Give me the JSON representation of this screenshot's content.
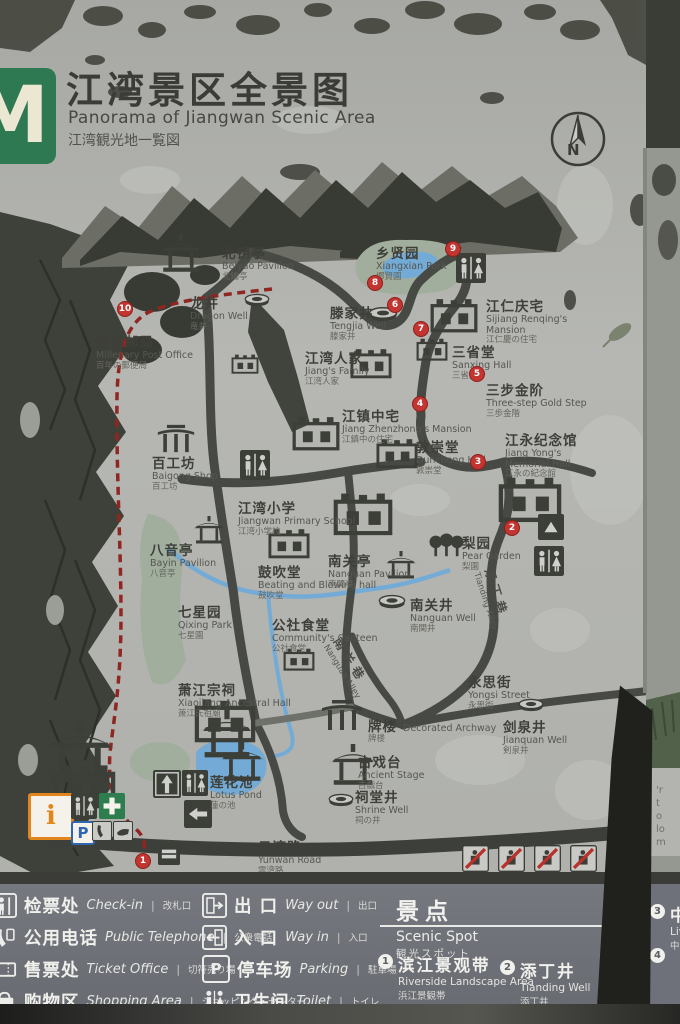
{
  "sign": {
    "logo_letter": "M",
    "title_zh": "江湾景区全景图",
    "title_en": "Panorama of Jiangwan Scenic Area",
    "title_ja": "江湾観光地一覧図",
    "compass_n": "N"
  },
  "colors": {
    "concrete": "#b2b3af",
    "ink": "#3c3e38",
    "road": "#474944",
    "water": "#74abd6",
    "park": "#a1ae9d",
    "marker_red": "#c23530",
    "route_red": "#8f2621",
    "legend_band": "#6e717a",
    "logo_green": "#2e7951",
    "info_orange": "#e2861c",
    "parking_blue": "#2f66b0"
  },
  "icons": {
    "parking_letter": "P",
    "info_letter": "i"
  },
  "map": {
    "locations": [
      {
        "id": "beiyao-pavilion",
        "zh": "北钥亭",
        "en": "Beiyao Pavilion",
        "ja": "北鑰亭",
        "x": 222,
        "y": 247
      },
      {
        "id": "dragon-well",
        "zh": "龙井",
        "en": "Dragon Well",
        "ja": "竜井",
        "x": 190,
        "y": 297
      },
      {
        "id": "millenary-post-office",
        "zh": "百年邮局",
        "en": "Millenary Post Office",
        "ja": "百年の郵便局",
        "x": 96,
        "y": 336
      },
      {
        "id": "tengjia-well",
        "zh": "滕家井",
        "en": "Tengjia Well",
        "ja": "滕家井",
        "x": 330,
        "y": 307
      },
      {
        "id": "xiangxian-park",
        "zh": "乡贤园",
        "en": "Xiangxian Park",
        "ja": "郷賢園",
        "x": 376,
        "y": 247
      },
      {
        "id": "sijiang-renqing-mansion",
        "zh": "江仁庆宅",
        "en": "Sijiang Renqing's Mansion",
        "ja": "江仁慶の住宅",
        "x": 486,
        "y": 300,
        "wrap": 100
      },
      {
        "id": "sanxing-hall",
        "zh": "三省堂",
        "en": "Sanxing Hall",
        "ja": "三省堂",
        "x": 452,
        "y": 346
      },
      {
        "id": "three-step-gold-step",
        "zh": "三步金阶",
        "en": "Three-step Gold Step",
        "ja": "三歩金階",
        "x": 486,
        "y": 384
      },
      {
        "id": "jiangs-family",
        "zh": "江湾人家",
        "en": "Jiang's Family",
        "ja": "江湾人家",
        "x": 305,
        "y": 352
      },
      {
        "id": "jiang-zhenzhong-mansion",
        "zh": "江镇中宅",
        "en": "Jiang Zhenzhong's Mansion",
        "ja": "江鎮中の住宅",
        "x": 342,
        "y": 410
      },
      {
        "id": "dunchong-hall",
        "zh": "敦崇堂",
        "en": "Dunchong Hall",
        "ja": "敦崇堂",
        "x": 416,
        "y": 441
      },
      {
        "id": "jiang-yong-memorial-hall",
        "zh": "江永纪念馆",
        "en": "Jiang Yong's Memorial Hall",
        "ja": "江永の紀念館",
        "x": 505,
        "y": 434,
        "wrap": 92
      },
      {
        "id": "baigong-shop",
        "zh": "百工坊",
        "en": "Baigong Shop",
        "ja": "百工坊",
        "x": 152,
        "y": 457
      },
      {
        "id": "jiangwan-primary-school",
        "zh": "江湾小学",
        "en": "Jiangwan Primary School",
        "ja": "江湾小学校",
        "x": 238,
        "y": 502
      },
      {
        "id": "bayin-pavilion",
        "zh": "八音亭",
        "en": "Bayin Pavilion",
        "ja": "八音亭",
        "x": 150,
        "y": 544
      },
      {
        "id": "beating-blowing-hall",
        "zh": "鼓吹堂",
        "en": "Beating and Blowing hall",
        "ja": "鼓吹堂",
        "x": 258,
        "y": 566
      },
      {
        "id": "nanguan-pavilion",
        "zh": "南关亭",
        "en": "Nanguan Pavilion",
        "ja": "南関亭",
        "x": 328,
        "y": 555
      },
      {
        "id": "pear-garden",
        "zh": "梨园",
        "en": "Pear Garden",
        "ja": "梨園",
        "x": 462,
        "y": 537
      },
      {
        "id": "nanguan-well",
        "zh": "南关井",
        "en": "Nanguan Well",
        "ja": "南関井",
        "x": 410,
        "y": 599
      },
      {
        "id": "qixing-park",
        "zh": "七星园",
        "en": "Qixing Park",
        "ja": "七星園",
        "x": 178,
        "y": 606
      },
      {
        "id": "communitys-canteen",
        "zh": "公社食堂",
        "en": "Community's Canteen",
        "ja": "公社食堂",
        "x": 272,
        "y": 619
      },
      {
        "id": "xiaojiang-ancestral-hall",
        "zh": "萧江宗祠",
        "en": "Xiaojiang Ancestral Hall",
        "ja": "萧江氏祖廟",
        "x": 178,
        "y": 684
      },
      {
        "id": "yongsi-street",
        "zh": "永思街",
        "en": "Yongsi Street",
        "ja": "永思街",
        "x": 468,
        "y": 676
      },
      {
        "id": "decorated-archway",
        "zh": "牌楼",
        "en": "Decorated Archway",
        "ja": "牌楼",
        "x": 368,
        "y": 717,
        "layout": "inline"
      },
      {
        "id": "jianquan-well",
        "zh": "剑泉井",
        "en": "Jianquan Well",
        "ja": "剣泉井",
        "x": 503,
        "y": 721
      },
      {
        "id": "ancient-stage",
        "zh": "古戏台",
        "en": "Ancient Stage",
        "ja": "古戯台",
        "x": 358,
        "y": 756
      },
      {
        "id": "shrine-well",
        "zh": "祠堂井",
        "en": "Shrine Well",
        "ja": "祠の井",
        "x": 355,
        "y": 791
      },
      {
        "id": "lotus-pond",
        "zh": "莲花池",
        "en": "Lotus Pond",
        "ja": "蓮の池",
        "x": 210,
        "y": 776
      },
      {
        "id": "yunwan-road",
        "zh": "云湾路",
        "en": "Yunwan Road",
        "ja": "雲湾路",
        "x": 258,
        "y": 841
      }
    ],
    "alley_labels": [
      {
        "id": "tianding-alley",
        "zh": "添丁巷",
        "en": "Tianding Alley",
        "x": 497,
        "y": 566,
        "rotate": 72
      },
      {
        "id": "nanguan-alley",
        "zh": "南关巷",
        "en": "Nanguan Alley",
        "x": 344,
        "y": 634,
        "rotate": 58
      }
    ],
    "markers": [
      {
        "num": "1",
        "x": 143,
        "y": 861
      },
      {
        "num": "2",
        "x": 512,
        "y": 528
      },
      {
        "num": "3",
        "x": 478,
        "y": 462
      },
      {
        "num": "4",
        "x": 420,
        "y": 404
      },
      {
        "num": "5",
        "x": 477,
        "y": 374
      },
      {
        "num": "6",
        "x": 395,
        "y": 305
      },
      {
        "num": "7",
        "x": 421,
        "y": 329
      },
      {
        "num": "8",
        "x": 375,
        "y": 283
      },
      {
        "num": "9",
        "x": 453,
        "y": 249
      },
      {
        "num": "10",
        "x": 125,
        "y": 309
      }
    ],
    "icons": [
      {
        "type": "pavilion",
        "x": 158,
        "y": 234,
        "s": 46
      },
      {
        "type": "well",
        "x": 244,
        "y": 291,
        "s": 26
      },
      {
        "type": "house",
        "x": 231,
        "y": 354,
        "s": 28
      },
      {
        "type": "well",
        "x": 368,
        "y": 304,
        "s": 30
      },
      {
        "type": "toilet",
        "x": 456,
        "y": 253,
        "s": 30
      },
      {
        "type": "house",
        "x": 430,
        "y": 298,
        "s": 48
      },
      {
        "type": "house",
        "x": 416,
        "y": 338,
        "s": 32
      },
      {
        "type": "house",
        "x": 350,
        "y": 348,
        "s": 42
      },
      {
        "type": "house",
        "x": 292,
        "y": 416,
        "s": 48
      },
      {
        "type": "house",
        "x": 376,
        "y": 438,
        "s": 42
      },
      {
        "type": "house",
        "x": 498,
        "y": 476,
        "s": 64
      },
      {
        "type": "archway",
        "x": 156,
        "y": 423,
        "s": 40
      },
      {
        "type": "toilet",
        "x": 240,
        "y": 450,
        "s": 30
      },
      {
        "type": "house",
        "x": 333,
        "y": 492,
        "s": 60
      },
      {
        "type": "pavilion",
        "x": 192,
        "y": 516,
        "s": 34
      },
      {
        "type": "house",
        "x": 268,
        "y": 528,
        "s": 42
      },
      {
        "type": "pavilion",
        "x": 384,
        "y": 551,
        "s": 34
      },
      {
        "type": "trees",
        "x": 428,
        "y": 533,
        "s": 36
      },
      {
        "type": "sign-dark",
        "x": 538,
        "y": 514,
        "s": 26
      },
      {
        "type": "toilet",
        "x": 534,
        "y": 546,
        "s": 30
      },
      {
        "type": "well",
        "x": 378,
        "y": 592,
        "s": 28
      },
      {
        "type": "house",
        "x": 283,
        "y": 648,
        "s": 32
      },
      {
        "type": "house",
        "x": 194,
        "y": 698,
        "s": 62
      },
      {
        "type": "pavilion",
        "x": 42,
        "y": 720,
        "s": 76
      },
      {
        "type": "house",
        "x": 54,
        "y": 764,
        "s": 62
      },
      {
        "type": "pavilion",
        "x": 198,
        "y": 710,
        "s": 58
      },
      {
        "type": "pavilion",
        "x": 218,
        "y": 742,
        "s": 48
      },
      {
        "type": "archway",
        "x": 320,
        "y": 698,
        "s": 44
      },
      {
        "type": "well",
        "x": 518,
        "y": 696,
        "s": 26
      },
      {
        "type": "pavilion",
        "x": 328,
        "y": 744,
        "s": 50
      },
      {
        "type": "well",
        "x": 328,
        "y": 791,
        "s": 26
      },
      {
        "type": "way-in",
        "x": 153,
        "y": 770,
        "s": 28
      },
      {
        "type": "toilet",
        "x": 182,
        "y": 770,
        "s": 26
      },
      {
        "type": "way-out",
        "x": 184,
        "y": 800,
        "s": 28
      },
      {
        "type": "ticket-dark",
        "x": 158,
        "y": 843,
        "s": 22
      },
      {
        "type": "info-box",
        "x": 28,
        "y": 793,
        "s": 40
      },
      {
        "type": "toilet",
        "x": 71,
        "y": 793,
        "s": 26
      },
      {
        "type": "cross-box",
        "x": 99,
        "y": 793,
        "s": 26
      },
      {
        "type": "p-box",
        "x": 71,
        "y": 821,
        "s": 20
      },
      {
        "type": "phone-box",
        "x": 92,
        "y": 821,
        "s": 20
      },
      {
        "type": "hand-box",
        "x": 113,
        "y": 821,
        "s": 20
      },
      {
        "type": "prohibit",
        "x": 462,
        "y": 845,
        "s": 27
      },
      {
        "type": "prohibit",
        "x": 498,
        "y": 845,
        "s": 27
      },
      {
        "type": "prohibit",
        "x": 534,
        "y": 845,
        "s": 27
      },
      {
        "type": "prohibit",
        "x": 570,
        "y": 845,
        "s": 27
      }
    ]
  },
  "legend": {
    "separator": "|",
    "columns": [
      {
        "x": -8,
        "items": [
          {
            "icon": "checkin",
            "zh": "检票处",
            "en": "Check-in",
            "ja": "改札口"
          },
          {
            "icon": "phone",
            "zh": "公用电话",
            "en": "Public Telephone",
            "ja": "公衆電話"
          },
          {
            "icon": "ticket",
            "zh": "售票处",
            "en": "Ticket Office",
            "ja": "切符売り場"
          },
          {
            "icon": "shopping",
            "zh": "购物区",
            "en": "Shopping Area",
            "ja": "ショッピング・センター"
          }
        ]
      },
      {
        "x": 202,
        "items": [
          {
            "icon": "way-out",
            "zh": "出 口",
            "en": "Way out",
            "ja": "出口"
          },
          {
            "icon": "way-in",
            "zh": "入 口",
            "en": "Way in",
            "ja": "入口"
          },
          {
            "icon": "parking",
            "zh": "停车场",
            "en": "Parking",
            "ja": "駐車場"
          },
          {
            "icon": "toilet",
            "zh": "卫生间",
            "en": "Toilet",
            "ja": "トイレ"
          }
        ]
      }
    ],
    "scenic": {
      "title_zh": "景点",
      "title_en": "Scenic Spot",
      "title_ja": "観光スポット",
      "spots": [
        {
          "num": "1",
          "zh": "滨江景观带",
          "en": "Riverside Landscape Area",
          "ja": "浜江景観帯",
          "x": 378,
          "y": 68
        },
        {
          "num": "2",
          "zh": "添丁井",
          "en": "Tianding Well",
          "ja": "添丁井",
          "x": 500,
          "y": 74
        }
      ]
    }
  },
  "side_panel": {
    "fragments": [
      "'r",
      "t",
      "o",
      "lo",
      "m"
    ],
    "spots": [
      {
        "num": "3",
        "zh": "中",
        "en": "Liv",
        "ja": "中",
        "y": 18
      },
      {
        "num": "4",
        "zh": "",
        "en": "",
        "ja": "",
        "y": 62
      }
    ]
  }
}
